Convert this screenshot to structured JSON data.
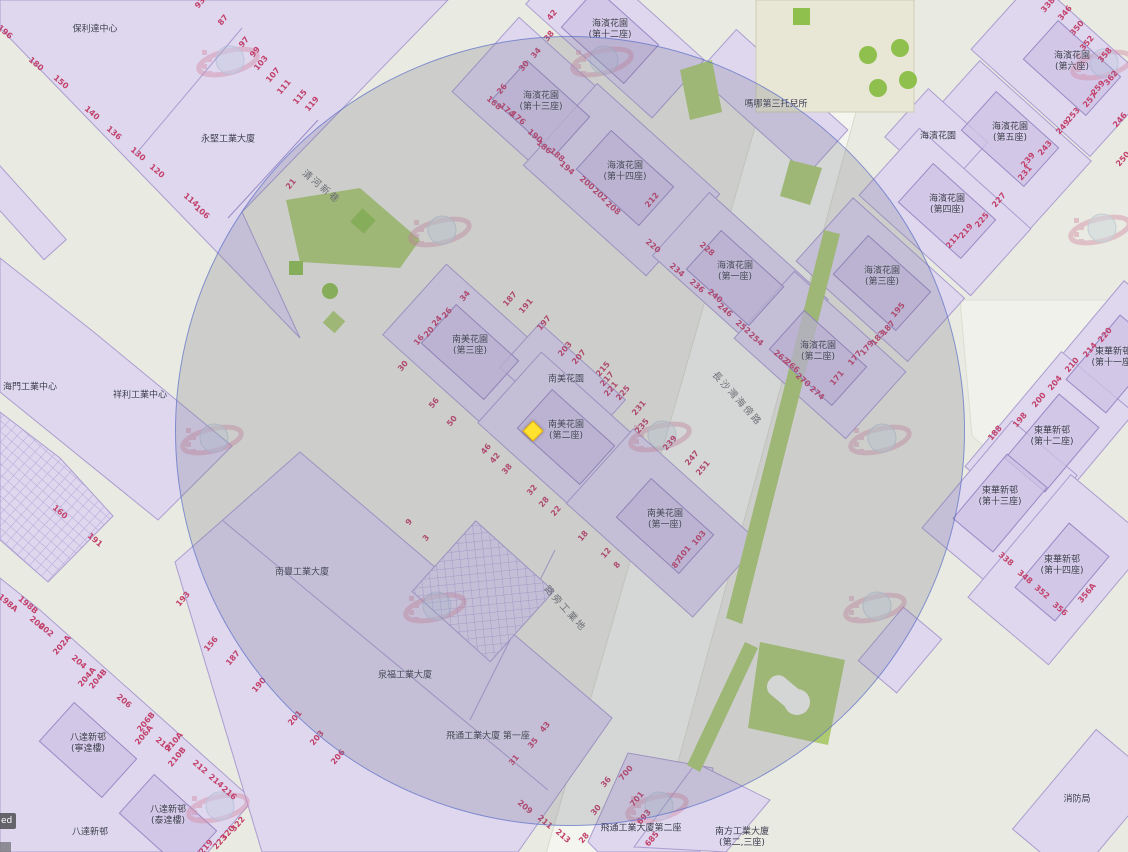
{
  "app": {
    "type": "web-map-viewer"
  },
  "attribution": {
    "text": "ed"
  },
  "overlay": {
    "radius_circle": {
      "cx": 569,
      "cy": 430,
      "r": 394,
      "fill": "rgba(106,110,133,0.22)",
      "stroke": "#586cca"
    },
    "marker": {
      "x": 533,
      "y": 431,
      "shape": "diamond",
      "color": "#ffe22e"
    }
  },
  "colors": {
    "parcel": "#ded7ee",
    "building": "#cdc2e4",
    "road": "#f4f5ee",
    "base": "#e9eae1",
    "green": "#aecb72",
    "number": "#c2416b",
    "label": "#3a3a4c"
  },
  "map": {
    "street_names": [
      {
        "t": "清河新巷",
        "x": 322,
        "y": 186,
        "r": 40
      },
      {
        "t": "長沙灣海傍路",
        "x": 738,
        "y": 398,
        "r": 48
      },
      {
        "t": "路旁工業地",
        "x": 566,
        "y": 608,
        "r": 48
      }
    ],
    "building_labels": [
      {
        "t": "保利達中心",
        "x": 95,
        "y": 30,
        "b": 0
      },
      {
        "t": "永堅工業大廈",
        "x": 228,
        "y": 140,
        "b": 0
      },
      {
        "t": "海濱花園\n(第十二座)",
        "x": 610,
        "y": 30,
        "b": 1
      },
      {
        "t": "海濱花園\n(第十三座)",
        "x": 541,
        "y": 102,
        "b": 1
      },
      {
        "t": "海濱花園\n(第十四座)",
        "x": 625,
        "y": 172,
        "b": 1
      },
      {
        "t": "嗎哪第三托兒所",
        "x": 776,
        "y": 105,
        "b": 0
      },
      {
        "t": "海濱花園\n(第六座)",
        "x": 1072,
        "y": 62,
        "b": 1
      },
      {
        "t": "海濱花園\n(第五座)",
        "x": 1010,
        "y": 133,
        "b": 1
      },
      {
        "t": "海濱花園",
        "x": 938,
        "y": 137,
        "b": 0
      },
      {
        "t": "海濱花園\n(第四座)",
        "x": 947,
        "y": 205,
        "b": 1
      },
      {
        "t": "海濱花園\n(第一座)",
        "x": 735,
        "y": 272,
        "b": 1
      },
      {
        "t": "海濱花園\n(第三座)",
        "x": 882,
        "y": 277,
        "b": 1
      },
      {
        "t": "海濱花園\n(第二座)",
        "x": 818,
        "y": 352,
        "b": 1
      },
      {
        "t": "南美花園\n(第三座)",
        "x": 470,
        "y": 346,
        "b": 1
      },
      {
        "t": "南美花園",
        "x": 566,
        "y": 380,
        "b": 0
      },
      {
        "t": "南美花園\n(第二座)",
        "x": 566,
        "y": 431,
        "b": 1
      },
      {
        "t": "南美花園\n(第一座)",
        "x": 665,
        "y": 520,
        "b": 1
      },
      {
        "t": "東華新邨\n(第十一座)",
        "x": 1113,
        "y": 358,
        "b": 1,
        "r": -50
      },
      {
        "t": "東華新邨\n(第十二座)",
        "x": 1052,
        "y": 437,
        "b": 1,
        "r": -50
      },
      {
        "t": "東華新邨\n(第十三座)",
        "x": 1000,
        "y": 497,
        "b": 1,
        "r": -50
      },
      {
        "t": "東華新邨\n(第十四座)",
        "x": 1062,
        "y": 566,
        "b": 1,
        "r": -50
      },
      {
        "t": "海門工業中心",
        "x": 30,
        "y": 388,
        "b": 0
      },
      {
        "t": "祥利工業中心",
        "x": 140,
        "y": 396,
        "b": 0
      },
      {
        "t": "南豐工業大廈",
        "x": 302,
        "y": 573,
        "b": 0
      },
      {
        "t": "泉福工業大廈",
        "x": 405,
        "y": 676,
        "b": 0
      },
      {
        "t": "飛通工業大廈 第一座",
        "x": 488,
        "y": 737,
        "b": 0
      },
      {
        "t": "飛通工業大廈第二座",
        "x": 641,
        "y": 829,
        "b": 0
      },
      {
        "t": "南方工業大廈\n(第二,三座)",
        "x": 742,
        "y": 838,
        "b": 0
      },
      {
        "t": "消防局",
        "x": 1077,
        "y": 800,
        "b": 0
      },
      {
        "t": "八達新邨\n(寧達樓)",
        "x": 88,
        "y": 744,
        "b": 1
      },
      {
        "t": "八達新邨\n(泰達樓)",
        "x": 168,
        "y": 816,
        "b": 1
      },
      {
        "t": "八達新邨",
        "x": 90,
        "y": 833,
        "b": 0
      }
    ],
    "street_numbers": [
      [
        "196",
        5,
        32,
        40
      ],
      [
        "180",
        36,
        64,
        40
      ],
      [
        "150",
        61,
        82,
        40
      ],
      [
        "140",
        92,
        113,
        40
      ],
      [
        "136",
        114,
        133,
        40
      ],
      [
        "130",
        138,
        154,
        40
      ],
      [
        "120",
        157,
        171,
        40
      ],
      [
        "114",
        191,
        200,
        40
      ],
      [
        "106",
        202,
        212,
        40
      ],
      [
        "93",
        200,
        3,
        -50
      ],
      [
        "87",
        223,
        20,
        -50
      ],
      [
        "97",
        244,
        42,
        -50
      ],
      [
        "99",
        255,
        52,
        -50
      ],
      [
        "103",
        261,
        63,
        -50
      ],
      [
        "107",
        273,
        75,
        -50
      ],
      [
        "111",
        284,
        87,
        -50
      ],
      [
        "115",
        300,
        97,
        -50
      ],
      [
        "119",
        312,
        104,
        -50
      ],
      [
        "21",
        291,
        184,
        -50
      ],
      [
        "42",
        552,
        15,
        -50
      ],
      [
        "38",
        549,
        36,
        -50
      ],
      [
        "34",
        536,
        53,
        -50
      ],
      [
        "30",
        524,
        66,
        -50
      ],
      [
        "26",
        502,
        89,
        -50
      ],
      [
        "168",
        494,
        103,
        40
      ],
      [
        "174",
        507,
        110,
        40
      ],
      [
        "176",
        518,
        118,
        40
      ],
      [
        "190",
        535,
        136,
        40
      ],
      [
        "186",
        544,
        147,
        40
      ],
      [
        "188",
        557,
        155,
        40
      ],
      [
        "194",
        567,
        168,
        40
      ],
      [
        "200",
        587,
        183,
        40
      ],
      [
        "202",
        600,
        195,
        40
      ],
      [
        "208",
        613,
        208,
        40
      ],
      [
        "212",
        652,
        200,
        -50
      ],
      [
        "338",
        1048,
        5,
        -50
      ],
      [
        "346",
        1065,
        13,
        -50
      ],
      [
        "350",
        1077,
        28,
        -50
      ],
      [
        "352",
        1087,
        43,
        -50
      ],
      [
        "358",
        1105,
        55,
        -50
      ],
      [
        "362",
        1111,
        78,
        -50
      ],
      [
        "246",
        1120,
        120,
        -50
      ],
      [
        "250",
        1123,
        159,
        -50
      ],
      [
        "259",
        1098,
        88,
        -50
      ],
      [
        "257",
        1090,
        100,
        -50
      ],
      [
        "253",
        1073,
        115,
        -50
      ],
      [
        "249",
        1063,
        127,
        -50
      ],
      [
        "243",
        1045,
        148,
        -50
      ],
      [
        "239",
        1028,
        160,
        -50
      ],
      [
        "231",
        1025,
        173,
        -50
      ],
      [
        "227",
        999,
        200,
        -50
      ],
      [
        "225",
        982,
        220,
        -50
      ],
      [
        "219",
        966,
        231,
        -50
      ],
      [
        "211",
        953,
        241,
        -50
      ],
      [
        "220",
        653,
        246,
        40
      ],
      [
        "228",
        707,
        249,
        40
      ],
      [
        "234",
        677,
        270,
        40
      ],
      [
        "236",
        697,
        286,
        40
      ],
      [
        "240",
        715,
        296,
        40
      ],
      [
        "246",
        725,
        310,
        40
      ],
      [
        "252",
        743,
        327,
        40
      ],
      [
        "254",
        756,
        339,
        40
      ],
      [
        "262",
        781,
        357,
        40
      ],
      [
        "266",
        792,
        366,
        40
      ],
      [
        "270",
        803,
        380,
        40
      ],
      [
        "274",
        817,
        393,
        40
      ],
      [
        "171",
        837,
        378,
        -50
      ],
      [
        "177",
        855,
        358,
        -50
      ],
      [
        "179",
        867,
        348,
        -50
      ],
      [
        "183",
        878,
        338,
        -50
      ],
      [
        "187",
        888,
        328,
        -50
      ],
      [
        "195",
        898,
        310,
        -50
      ],
      [
        "220",
        1105,
        335,
        -50
      ],
      [
        "214",
        1090,
        350,
        -50
      ],
      [
        "210",
        1072,
        365,
        -50
      ],
      [
        "204",
        1055,
        383,
        -50
      ],
      [
        "200",
        1039,
        400,
        -50
      ],
      [
        "198",
        1020,
        420,
        -50
      ],
      [
        "188",
        995,
        433,
        -50
      ],
      [
        "338",
        1006,
        559,
        40
      ],
      [
        "348",
        1025,
        577,
        40
      ],
      [
        "352",
        1042,
        592,
        40
      ],
      [
        "356",
        1060,
        609,
        40
      ],
      [
        "356A",
        1087,
        593,
        -50
      ],
      [
        "34",
        465,
        296,
        -50
      ],
      [
        "26",
        447,
        313,
        -50
      ],
      [
        "24",
        437,
        321,
        -50
      ],
      [
        "20",
        429,
        332,
        -50
      ],
      [
        "16",
        419,
        340,
        -50
      ],
      [
        "30",
        403,
        366,
        -50
      ],
      [
        "56",
        434,
        403,
        -50
      ],
      [
        "50",
        452,
        421,
        -50
      ],
      [
        "46",
        486,
        449,
        -50
      ],
      [
        "42",
        495,
        458,
        -50
      ],
      [
        "38",
        507,
        469,
        -50
      ],
      [
        "32",
        532,
        490,
        -50
      ],
      [
        "28",
        544,
        502,
        -50
      ],
      [
        "22",
        556,
        511,
        -50
      ],
      [
        "18",
        583,
        536,
        -50
      ],
      [
        "12",
        606,
        553,
        -50
      ],
      [
        "8",
        617,
        565,
        -50
      ],
      [
        "9",
        409,
        522,
        -50
      ],
      [
        "3",
        426,
        538,
        -50
      ],
      [
        "187",
        510,
        299,
        -50
      ],
      [
        "191",
        526,
        306,
        -50
      ],
      [
        "197",
        544,
        323,
        -50
      ],
      [
        "203",
        565,
        349,
        -50
      ],
      [
        "207",
        579,
        357,
        -50
      ],
      [
        "215",
        603,
        369,
        -50
      ],
      [
        "217",
        607,
        379,
        -50
      ],
      [
        "221",
        611,
        389,
        -50
      ],
      [
        "225",
        623,
        393,
        -50
      ],
      [
        "231",
        639,
        408,
        -50
      ],
      [
        "235",
        642,
        426,
        -50
      ],
      [
        "239",
        670,
        443,
        -50
      ],
      [
        "247",
        692,
        458,
        -50
      ],
      [
        "251",
        703,
        468,
        -50
      ],
      [
        "103",
        699,
        538,
        -50
      ],
      [
        "101",
        684,
        553,
        -50
      ],
      [
        "87",
        677,
        563,
        -50
      ],
      [
        "160",
        60,
        512,
        40
      ],
      [
        "191",
        95,
        540,
        40
      ],
      [
        "198A",
        8,
        603,
        40
      ],
      [
        "198B",
        28,
        605,
        40
      ],
      [
        "200",
        37,
        623,
        40
      ],
      [
        "202",
        46,
        630,
        40
      ],
      [
        "202A",
        62,
        645,
        -50
      ],
      [
        "204",
        79,
        662,
        40
      ],
      [
        "204A",
        87,
        677,
        -50
      ],
      [
        "204B",
        98,
        679,
        -50
      ],
      [
        "206",
        124,
        701,
        40
      ],
      [
        "206B",
        146,
        722,
        -50
      ],
      [
        "206A",
        144,
        735,
        -50
      ],
      [
        "210",
        163,
        744,
        40
      ],
      [
        "210A",
        174,
        742,
        -50
      ],
      [
        "210B",
        177,
        757,
        -50
      ],
      [
        "212",
        200,
        767,
        40
      ],
      [
        "214",
        216,
        781,
        40
      ],
      [
        "216",
        229,
        793,
        40
      ],
      [
        "219",
        206,
        847,
        -50
      ],
      [
        "223",
        220,
        842,
        -50
      ],
      [
        "320",
        228,
        833,
        -50
      ],
      [
        "322",
        238,
        824,
        -50
      ],
      [
        "193",
        183,
        599,
        -50
      ],
      [
        "156",
        211,
        644,
        -50
      ],
      [
        "187",
        233,
        658,
        -50
      ],
      [
        "190",
        259,
        685,
        -50
      ],
      [
        "201",
        295,
        718,
        -50
      ],
      [
        "203",
        317,
        738,
        -50
      ],
      [
        "206",
        338,
        757,
        -50
      ],
      [
        "209",
        525,
        807,
        40
      ],
      [
        "211",
        545,
        822,
        40
      ],
      [
        "213",
        563,
        836,
        40
      ],
      [
        "43",
        545,
        727,
        -50
      ],
      [
        "35",
        533,
        743,
        -50
      ],
      [
        "31",
        514,
        760,
        -50
      ],
      [
        "700",
        626,
        773,
        -50
      ],
      [
        "701",
        637,
        799,
        -50
      ],
      [
        "693",
        644,
        817,
        -50
      ],
      [
        "685",
        652,
        839,
        -50
      ],
      [
        "28",
        584,
        838,
        -50
      ],
      [
        "30",
        596,
        810,
        -50
      ],
      [
        "36",
        606,
        782,
        -50
      ]
    ],
    "watermarks": [
      [
        228,
        62
      ],
      [
        602,
        62
      ],
      [
        1102,
        65
      ],
      [
        440,
        232
      ],
      [
        1100,
        230
      ],
      [
        212,
        440
      ],
      [
        660,
        437
      ],
      [
        880,
        440
      ],
      [
        435,
        608
      ],
      [
        875,
        608
      ],
      [
        218,
        808
      ],
      [
        657,
        808
      ]
    ]
  }
}
